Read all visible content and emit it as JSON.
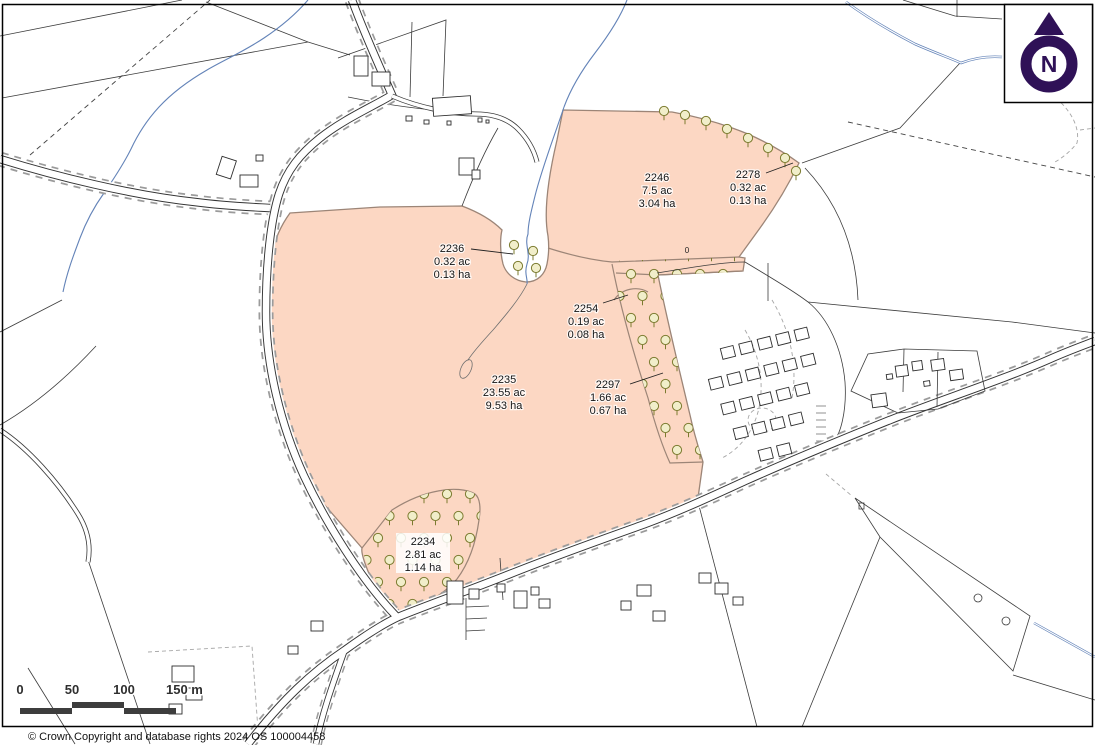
{
  "map": {
    "type": "ordnance-survey-land-parcel-plan",
    "parcels": [
      {
        "id": "2246",
        "area_ac": "7.5 ac",
        "area_ha": "3.04 ha"
      },
      {
        "id": "2278",
        "area_ac": "0.32 ac",
        "area_ha": "0.13 ha"
      },
      {
        "id": "2236",
        "area_ac": "0.32 ac",
        "area_ha": "0.13 ha"
      },
      {
        "id": "2254",
        "area_ac": "0.19 ac",
        "area_ha": "0.08 ha"
      },
      {
        "id": "2235",
        "area_ac": "23.55 ac",
        "area_ha": "9.53 ha"
      },
      {
        "id": "2297",
        "area_ac": "1.66 ac",
        "area_ha": "0.67 ha"
      },
      {
        "id": "2234",
        "area_ac": "2.81 ac",
        "area_ha": "1.14 ha"
      }
    ],
    "glyphs": {
      "gate_marker": "0"
    }
  },
  "scale_bar": {
    "labels": [
      "0",
      "50",
      "100",
      "150 m"
    ]
  },
  "north_arrow": {
    "label": "N"
  },
  "footer": {
    "copyright": "© Crown Copyright and database rights 2024 OS 100004458"
  },
  "colors": {
    "parcel_fill": "#fcd7c3",
    "parcel_outline": "#9c8577",
    "tree_outline": "#7b7b2f",
    "tree_fill": "#f1eeca",
    "water": "#6383b8",
    "north_arrow": "#2f1157",
    "scale_bar": "#3d3d3d"
  }
}
